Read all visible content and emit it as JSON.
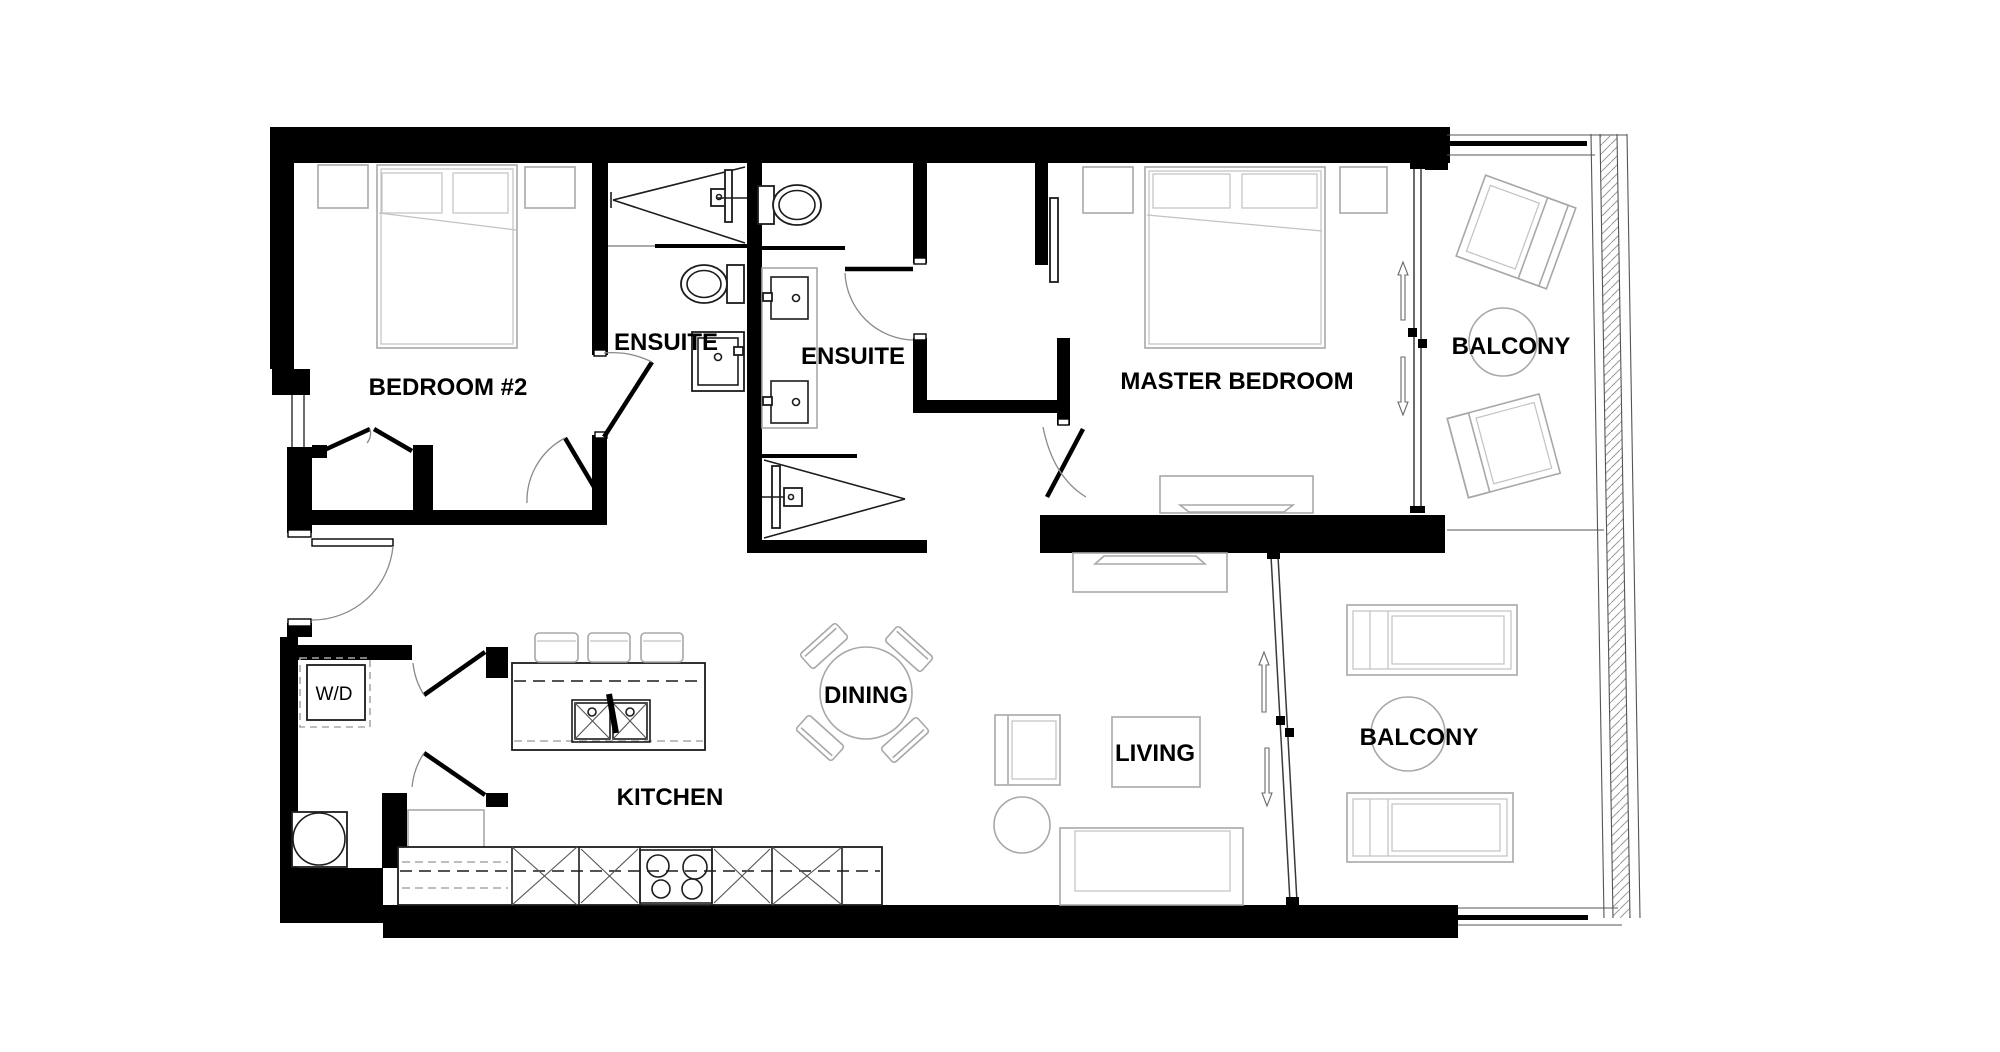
{
  "plan": {
    "type": "residential-floor-plan",
    "unit": "two-bedroom-two-bath-with-balconies"
  },
  "rooms": {
    "bedroom2": {
      "label": "BEDROOM #2"
    },
    "ensuite1": {
      "label": "ENSUITE"
    },
    "ensuite2": {
      "label": "ENSUITE"
    },
    "master_bedroom": {
      "label": "MASTER BEDROOM"
    },
    "balcony_upper": {
      "label": "BALCONY"
    },
    "balcony_lower": {
      "label": "BALCONY"
    },
    "kitchen": {
      "label": "KITCHEN"
    },
    "dining": {
      "label": "DINING"
    },
    "living": {
      "label": "LIVING"
    },
    "laundry": {
      "label": "W/D"
    }
  },
  "colors": {
    "wall": "#000000",
    "furniture_line": "#a8a8a8",
    "fixture_line": "#1c1c1c",
    "background": "#ffffff",
    "text": "#000000"
  }
}
